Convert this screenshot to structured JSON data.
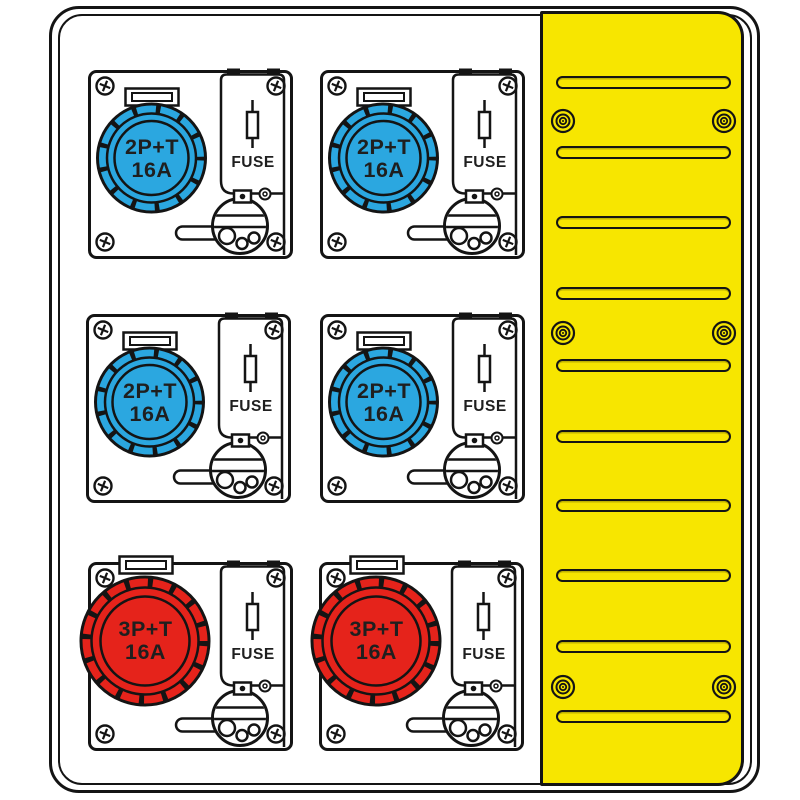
{
  "diagram": {
    "kind": "electrical-distribution-board-drawing",
    "colors": {
      "blue": "#2BA7E0",
      "red": "#E5231B",
      "yellow": "#F7E600",
      "line": "#141414",
      "text": "#1F1F1F"
    },
    "modules": [
      {
        "socket_type": "2P+T",
        "rating": "16A",
        "fuse_label": "FUSE",
        "color_key": "blue"
      },
      {
        "socket_type": "2P+T",
        "rating": "16A",
        "fuse_label": "FUSE",
        "color_key": "blue"
      },
      {
        "socket_type": "2P+T",
        "rating": "16A",
        "fuse_label": "FUSE",
        "color_key": "blue"
      },
      {
        "socket_type": "2P+T",
        "rating": "16A",
        "fuse_label": "FUSE",
        "color_key": "blue"
      },
      {
        "socket_type": "3P+T",
        "rating": "16A",
        "fuse_label": "FUSE",
        "color_key": "red"
      },
      {
        "socket_type": "3P+T",
        "rating": "16A",
        "fuse_label": "FUSE",
        "color_key": "red"
      }
    ],
    "cover_panel": {
      "vent_slot_count": 10,
      "screw_count": 6
    }
  }
}
